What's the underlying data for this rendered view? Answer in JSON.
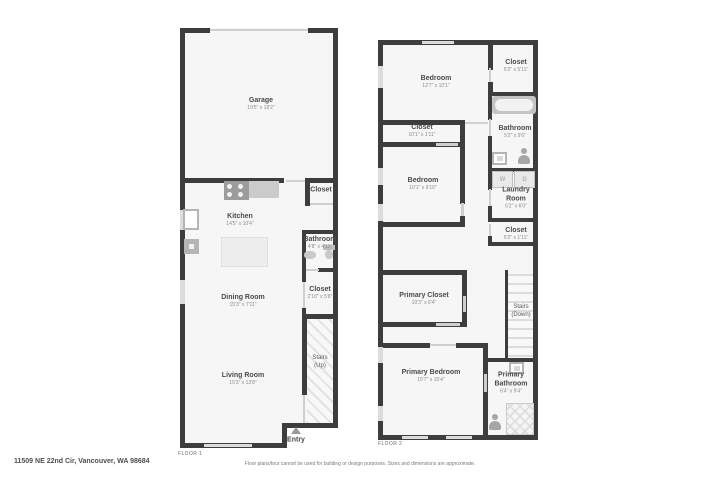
{
  "colors": {
    "wall": "#3d3d3d",
    "room_fill": "#f6f6f6",
    "fixture": "#c6c6c6",
    "text_primary": "#4a4a4a",
    "text_secondary": "#8b8b8b"
  },
  "floor1": {
    "label": "FLOOR 1",
    "rooms": {
      "garage": {
        "name": "Garage",
        "dims": "19'5\" x 18'2\""
      },
      "kitchen": {
        "name": "Kitchen",
        "dims": "14'5\" x 10'4\""
      },
      "closet_top": {
        "name": "Closet"
      },
      "bathroom": {
        "name": "Bathroom",
        "dims": "4'8\" x 4'11\""
      },
      "closet_mid": {
        "name": "Closet",
        "dims": "2'10\" x 5'8\""
      },
      "dining_room": {
        "name": "Dining Room",
        "dims": "15'3\" x 7'11\""
      },
      "living_room": {
        "name": "Living Room",
        "dims": "15'3\" x 13'8\""
      },
      "stairs": {
        "name": "Stairs",
        "sub": "(Up)"
      },
      "entry": {
        "name": "Entry"
      }
    }
  },
  "floor2": {
    "label": "FLOOR 2",
    "rooms": {
      "bedroom_top": {
        "name": "Bedroom",
        "dims": "12'7\" x 10'1\""
      },
      "closet_top_right": {
        "name": "Closet",
        "dims": "5'2\" x 5'11\""
      },
      "bathroom": {
        "name": "Bathroom",
        "dims": "5'2\" x 9'6\""
      },
      "closet_wide": {
        "name": "Closet",
        "dims": "10'1\" x 1'11\""
      },
      "bedroom_mid": {
        "name": "Bedroom",
        "dims": "10'1\" x 9'10\""
      },
      "laundry": {
        "name": "Laundry Room",
        "dims": "5'2\" x 6'0\""
      },
      "closet_right": {
        "name": "Closet",
        "dims": "5'2\" x 1'11\""
      },
      "primary_closet": {
        "name": "Primary Closet",
        "dims": "10'3\" x 6'4\""
      },
      "stairs": {
        "name": "Stairs",
        "sub": "(Down)"
      },
      "primary_bedroom": {
        "name": "Primary Bedroom",
        "dims": "15'7\" x 15'4\""
      },
      "primary_bathroom": {
        "name": "Primary Bathroom",
        "dims": "6'4\" x 9'4\""
      }
    },
    "fixtures": {
      "washer": "W",
      "dryer": "D"
    }
  },
  "footer": {
    "address": "11509 NE 22nd Cir, Vancouver, WA 98684",
    "disclaimer": "Floor plans/tour cannot be used for building or design purposes. Sizes and dimensions are approximate."
  }
}
